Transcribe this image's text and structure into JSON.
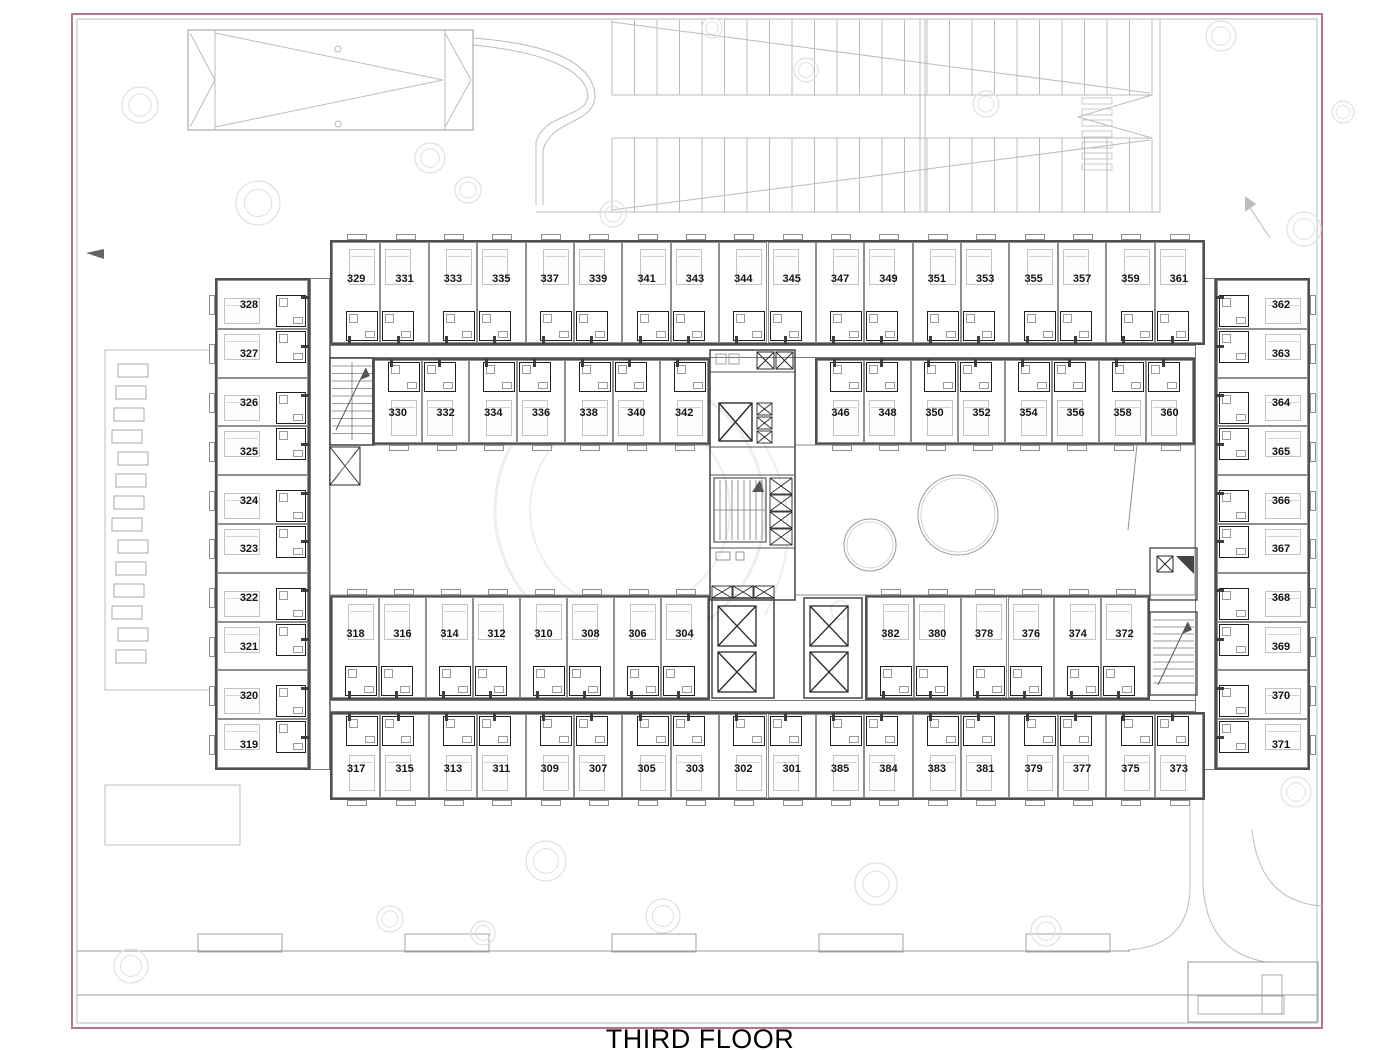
{
  "title": "THIRD FLOOR",
  "colors": {
    "border_outer": "#b57786",
    "border_inner": "#a9a9a9",
    "wall": "#4f4f4f",
    "room_line": "#8f8f8f",
    "bath_line": "#1f1f1f",
    "site_line": "#bcbcbc",
    "tree_line": "#e0e0e0",
    "watermark": "#eeeeee",
    "text": "#141414"
  },
  "icons": {
    "elevator": "x-box-icon",
    "shaft": "x-box-icon",
    "stairs": "stairs-icon",
    "tree": "tree-icon",
    "direction_arrow": "arrow-icon"
  },
  "rooms": {
    "top_row": [
      "329",
      "331",
      "333",
      "335",
      "337",
      "339",
      "341",
      "343",
      "344",
      "345",
      "347",
      "349",
      "351",
      "353",
      "355",
      "357",
      "359",
      "361"
    ],
    "upper_inner_left": [
      "330",
      "332",
      "334",
      "336",
      "338",
      "340",
      "342"
    ],
    "upper_inner_right": [
      "346",
      "348",
      "350",
      "352",
      "354",
      "356",
      "358",
      "360"
    ],
    "left_wing": [
      "328",
      "327",
      "326",
      "325",
      "324",
      "323",
      "322",
      "321",
      "320",
      "319"
    ],
    "right_wing": [
      "362",
      "363",
      "364",
      "365",
      "366",
      "367",
      "368",
      "369",
      "370",
      "371"
    ],
    "lower_inner_left": [
      "318",
      "316",
      "314",
      "312",
      "310",
      "308",
      "306",
      "304"
    ],
    "lower_inner_right": [
      "382",
      "380",
      "378",
      "376",
      "374",
      "372"
    ],
    "bottom_row": [
      "317",
      "315",
      "313",
      "311",
      "309",
      "307",
      "305",
      "303",
      "302",
      "301",
      "385",
      "384",
      "383",
      "381",
      "379",
      "377",
      "375",
      "373"
    ]
  }
}
